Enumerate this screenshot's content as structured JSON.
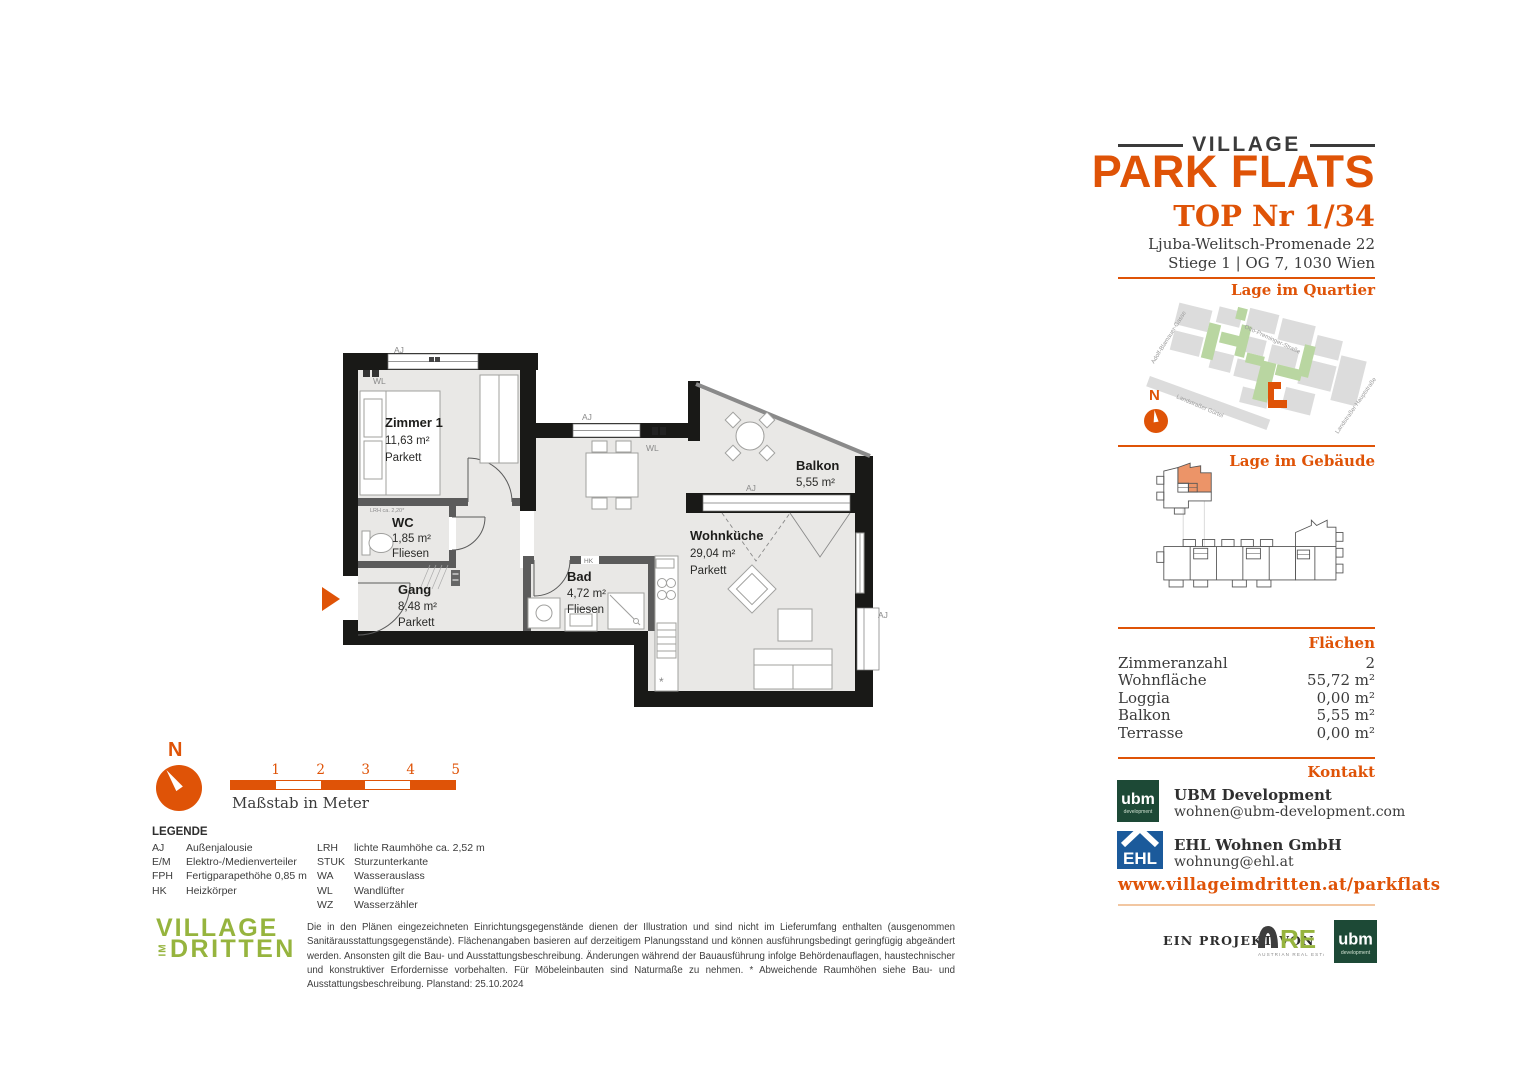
{
  "header": {
    "brand_top": "VILLAGE",
    "brand_main": "PARK FLATS",
    "unit_title": "TOP Nr 1/34",
    "address_line1": "Ljuba-Welitsch-Promenade 22",
    "address_line2": "Stiege 1 | OG 7, 1030 Wien"
  },
  "sections": {
    "quartier": "Lage im Quartier",
    "gebaeude": "Lage im Gebäude",
    "flaechen": "Flächen",
    "kontakt": "Kontakt"
  },
  "map": {
    "north_label": "N",
    "streets": [
      "Adolf-Blamauer-Gasse",
      "Otto-Preminger-Straße",
      "Landstraßer Gürtel",
      "Landstraßer Hauptstraße"
    ]
  },
  "areas": {
    "rows": [
      {
        "label": "Zimmeranzahl",
        "value": "2"
      },
      {
        "label": "Wohnfläche",
        "value": "55,72 m²"
      },
      {
        "label": "Loggia",
        "value": "0,00 m²"
      },
      {
        "label": "Balkon",
        "value": "5,55 m²"
      },
      {
        "label": "Terrasse",
        "value": "0,00 m²"
      }
    ]
  },
  "contact": {
    "ubm_name": "UBM Development",
    "ubm_email": "wohnen@ubm-development.com",
    "ehl_name": "EHL Wohnen GmbH",
    "ehl_email": "wohnung@ehl.at",
    "website": "www.villageimdritten.at/parkflats",
    "ubm_logo": "ubm",
    "ubm_logo_sub": "development",
    "ehl_logo": "EHL"
  },
  "plan": {
    "rooms": [
      {
        "name": "Zimmer 1",
        "area": "11,63 m²",
        "floor": "Parkett"
      },
      {
        "name": "WC",
        "area": "1,85 m²",
        "floor": "Fliesen"
      },
      {
        "name": "Gang",
        "area": "8,48 m²",
        "floor": "Parkett"
      },
      {
        "name": "Bad",
        "area": "4,72 m²",
        "floor": "Fliesen"
      },
      {
        "name": "Wohnküche",
        "area": "29,04 m²",
        "floor": "Parkett"
      },
      {
        "name": "Balkon",
        "area": "5,55 m²"
      }
    ],
    "labels": {
      "aj": "AJ",
      "wl": "WL",
      "hk": "HK",
      "asterisk": "*",
      "annotation": "LRH ca. 2,20*"
    }
  },
  "scalebar": {
    "ticks": [
      "1",
      "2",
      "3",
      "4",
      "5"
    ],
    "caption": "Maßstab in Meter",
    "north_label": "N"
  },
  "legend": {
    "title": "LEGENDE",
    "col1": [
      {
        "abbr": "AJ",
        "text": "Außenjalousie"
      },
      {
        "abbr": "E/M",
        "text": "Elektro-/Medienverteiler"
      },
      {
        "abbr": "FPH",
        "text": "Fertigparapethöhe 0,85 m"
      },
      {
        "abbr": "HK",
        "text": "Heizkörper"
      }
    ],
    "col2": [
      {
        "abbr": "LRH",
        "text": "lichte Raumhöhe ca. 2,52 m"
      },
      {
        "abbr": "STUK",
        "text": "Sturzunterkante"
      },
      {
        "abbr": "WA",
        "text": "Wasserauslass"
      },
      {
        "abbr": "WL",
        "text": "Wandlüfter"
      },
      {
        "abbr": "WZ",
        "text": "Wasserzähler"
      }
    ]
  },
  "footer": {
    "logo_line1": "VILLAGE",
    "logo_im": "IM",
    "logo_line2": "DRITTEN",
    "disclaimer": "Die in den Plänen eingezeichneten Einrichtungsgegenstände dienen der Illustration und sind nicht im Lieferumfang enthalten (ausgenommen Sanitärausstattungsgegenstände). Flächenangaben basieren auf derzeitigem Planungsstand und können ausführungsbedingt geringfügig abgeändert werden. Ansonsten gilt die Bau- und Ausstattungsbeschreibung. Änderungen während der Bauausführung infolge Behördenauflagen, haustechnischer und konstruktiver Erfordernisse vorbehalten. Für Möbeleinbauten sind Naturmaße zu nehmen. * Abweichende Raumhöhen siehe Bau- und Ausstattungsbeschreibung. Planstand: 25.10.2024",
    "projekt_label": "EIN PROJEKT VON",
    "are_logo": "RE",
    "are_sub": "AUSTRIAN REAL ESTATE"
  },
  "colors": {
    "accent": "#DF5307",
    "logo_green": "#96b43e",
    "map_green": "#b9d6a1",
    "map_gray": "#dcdcdc",
    "ubm_green": "#1d4936",
    "ehl_blue": "#1b5a9b"
  }
}
